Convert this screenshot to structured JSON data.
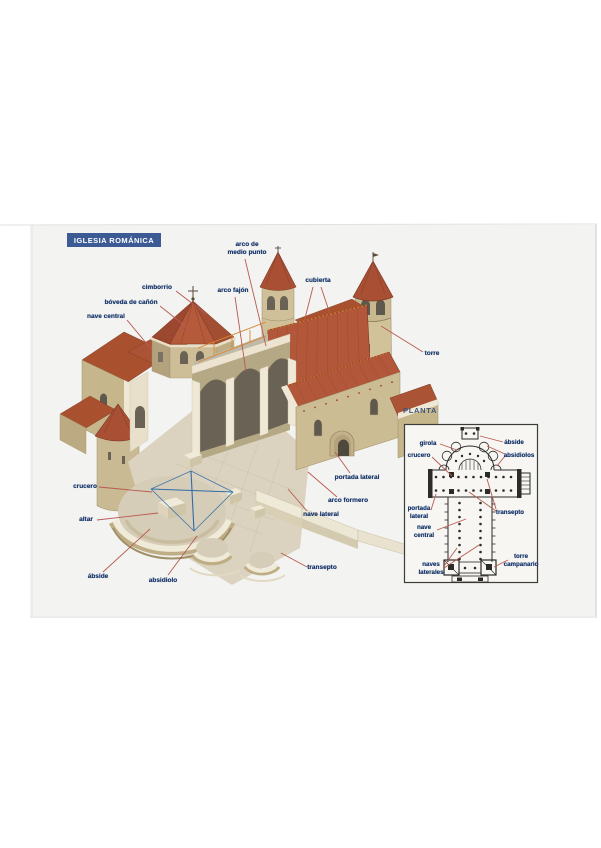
{
  "header": {
    "title": "IGLESIA ROMÁNICA"
  },
  "colors": {
    "banner": "#3c5a94",
    "label_text": "#1c3a6e",
    "leader": "#b85a50",
    "plan_ink": "#2b2b28",
    "cross_blue": "#2f6ba8",
    "roof_red": "#b2573a",
    "stone": "#ccbc93",
    "scan_background": "#f3f3f1"
  },
  "main_diagram": {
    "labels": [
      {
        "id": "arco-de-medio-punto",
        "text": "arco de\nmedio punto",
        "x": 247,
        "y": 241,
        "align": "center",
        "leaders": [
          [
            245,
            259,
            266,
            346
          ]
        ]
      },
      {
        "id": "cimborrio",
        "text": "cimborrio",
        "x": 157,
        "y": 284,
        "align": "center",
        "leaders": [
          [
            176,
            291,
            206,
            314
          ]
        ]
      },
      {
        "id": "boveda-de-canon",
        "text": "bóveda de cañón",
        "x": 131,
        "y": 299,
        "align": "center",
        "leaders": [
          [
            160,
            306,
            190,
            330
          ]
        ]
      },
      {
        "id": "nave-central",
        "text": "nave central",
        "x": 106,
        "y": 313,
        "align": "center",
        "leaders": [
          [
            127,
            320,
            152,
            350
          ]
        ]
      },
      {
        "id": "arco-fajon",
        "text": "arco fajón",
        "x": 233,
        "y": 287,
        "align": "center",
        "leaders": [
          [
            235,
            297,
            246,
            372
          ]
        ]
      },
      {
        "id": "cubierta",
        "text": "cubierta",
        "x": 318,
        "y": 277,
        "align": "center",
        "leaders": [
          [
            313,
            287,
            304,
            322
          ],
          [
            321,
            287,
            330,
            314
          ]
        ]
      },
      {
        "id": "torre",
        "text": "torre",
        "x": 432,
        "y": 350,
        "align": "center",
        "leaders": [
          [
            423,
            352,
            381,
            326
          ]
        ]
      },
      {
        "id": "crucero",
        "text": "crucero",
        "x": 85,
        "y": 483,
        "align": "center",
        "leaders": [
          [
            99,
            487,
            152,
            492
          ]
        ]
      },
      {
        "id": "altar",
        "text": "altar",
        "x": 86,
        "y": 516,
        "align": "center",
        "leaders": [
          [
            97,
            520,
            158,
            513
          ]
        ]
      },
      {
        "id": "abside",
        "text": "ábside",
        "x": 98,
        "y": 573,
        "align": "center",
        "leaders": [
          [
            103,
            572,
            150,
            529
          ]
        ]
      },
      {
        "id": "absidiolo",
        "text": "absidiolo",
        "x": 163,
        "y": 577,
        "align": "center",
        "leaders": [
          [
            168,
            575,
            197,
            536
          ]
        ]
      },
      {
        "id": "portada-lateral",
        "text": "portada lateral",
        "x": 357,
        "y": 474,
        "align": "center",
        "leaders": [
          [
            350,
            473,
            335,
            452
          ]
        ]
      },
      {
        "id": "arco-formero",
        "text": "arco formero",
        "x": 348,
        "y": 497,
        "align": "center",
        "leaders": [
          [
            337,
            497,
            308,
            472
          ]
        ]
      },
      {
        "id": "nave-lateral",
        "text": "nave lateral",
        "x": 321,
        "y": 511,
        "align": "center",
        "leaders": [
          [
            307,
            511,
            288,
            489
          ]
        ]
      },
      {
        "id": "transepto",
        "text": "transepto",
        "x": 322,
        "y": 564,
        "align": "center",
        "leaders": [
          [
            307,
            567,
            281,
            553
          ]
        ]
      }
    ]
  },
  "planta": {
    "title": "PLANTA",
    "labels": [
      {
        "id": "girola",
        "text": "girola",
        "x": 428,
        "y": 440,
        "align": "center",
        "leaders": [
          [
            440,
            444,
            457,
            450
          ]
        ]
      },
      {
        "id": "abside-plan",
        "text": "ábside",
        "x": 514,
        "y": 439,
        "align": "center",
        "leaders": [
          [
            503,
            442,
            480,
            436
          ]
        ]
      },
      {
        "id": "crucero-plan",
        "text": "crucero",
        "x": 419,
        "y": 452,
        "align": "center",
        "leaders": [
          [
            432,
            457,
            452,
            476
          ]
        ]
      },
      {
        "id": "absidiolos",
        "text": "absidiolos",
        "x": 519,
        "y": 452,
        "align": "center",
        "leaders": [
          [
            505,
            456,
            497,
            466
          ],
          [
            505,
            454,
            487,
            446
          ]
        ]
      },
      {
        "id": "portada-lateral-plan",
        "text": "portada\nlateral",
        "x": 419,
        "y": 505,
        "align": "center",
        "leaders": [
          [
            431,
            510,
            436,
            494
          ]
        ]
      },
      {
        "id": "transepto-plan",
        "text": "transepto",
        "x": 510,
        "y": 509,
        "align": "center",
        "leaders": [
          [
            496,
            511,
            469,
            492
          ],
          [
            496,
            509,
            487,
            479
          ]
        ]
      },
      {
        "id": "nave-central-plan",
        "text": "nave\ncentral",
        "x": 424,
        "y": 524,
        "align": "center",
        "leaders": [
          [
            437,
            530,
            466,
            519
          ]
        ]
      },
      {
        "id": "torre-campanario",
        "text": "torre\ncampanario",
        "x": 521,
        "y": 553,
        "align": "center",
        "leaders": [
          [
            508,
            560,
            494,
            567
          ]
        ]
      },
      {
        "id": "naves-laterales",
        "text": "naves\nlaterales",
        "x": 431,
        "y": 561,
        "align": "center",
        "leaders": [
          [
            444,
            566,
            457,
            548
          ],
          [
            444,
            568,
            479,
            545
          ]
        ]
      }
    ]
  }
}
